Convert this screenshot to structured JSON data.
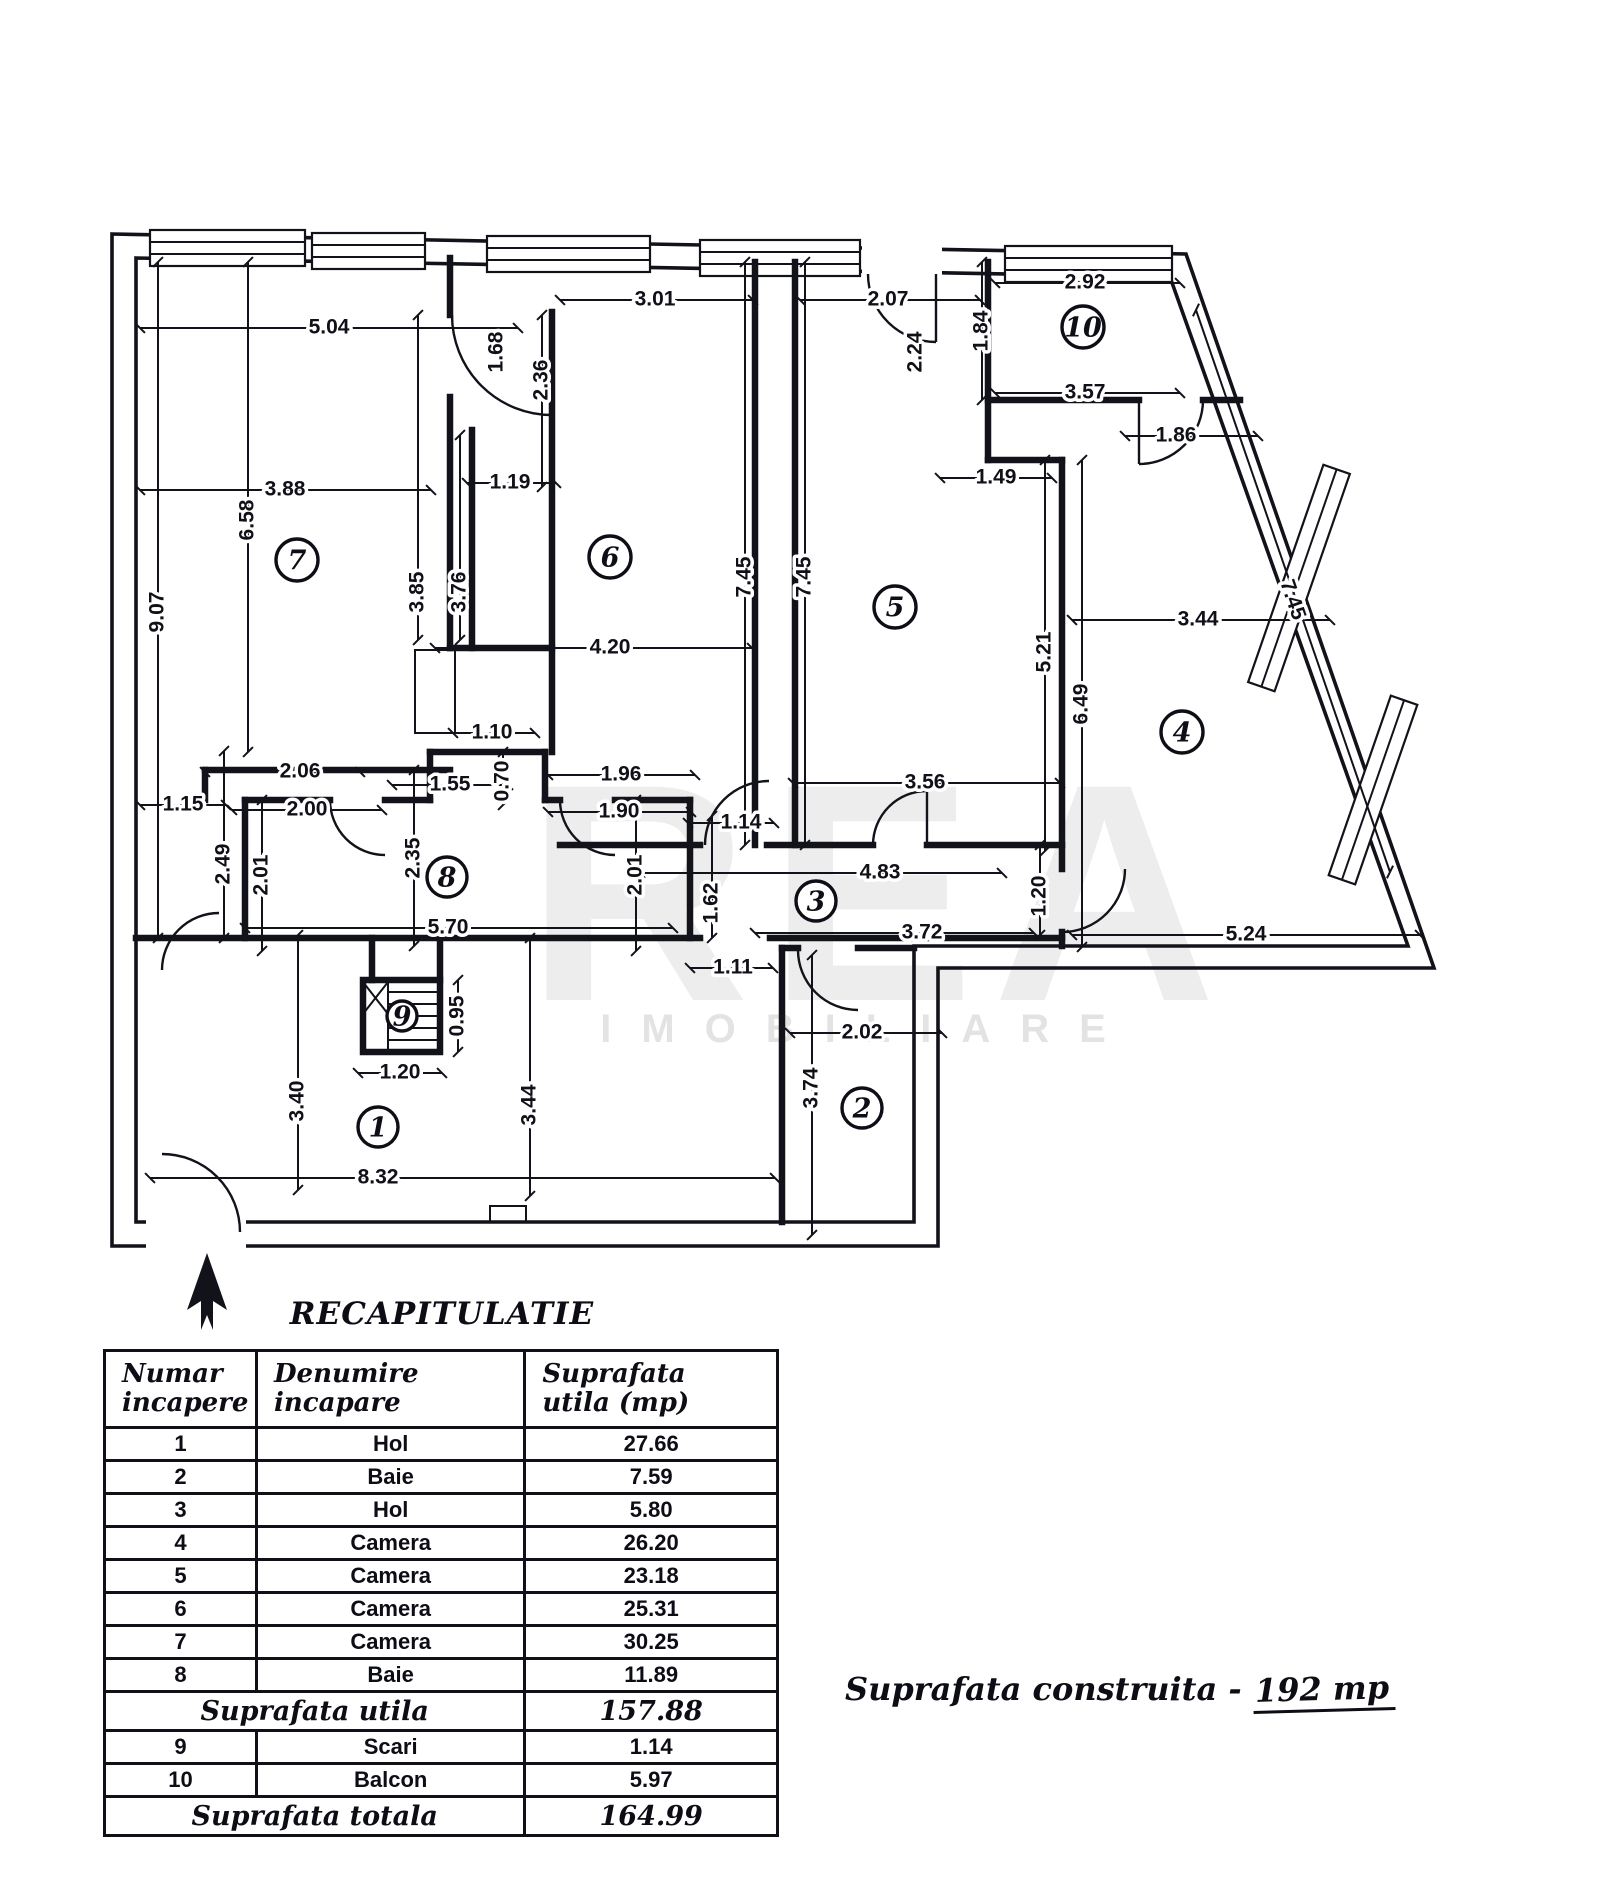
{
  "title": "RECAPITULATIE",
  "watermark": {
    "line1": "REA",
    "line2": "IMOBILIARE"
  },
  "plan": {
    "room_numbers": [
      "1",
      "2",
      "3",
      "4",
      "5",
      "6",
      "7",
      "8",
      "9",
      "10"
    ],
    "dims": [
      "5.04",
      "3.88",
      "6.58",
      "9.07",
      "1.68",
      "2.36",
      "1.19",
      "3.01",
      "3.85",
      "3.76",
      "4.20",
      "1.10",
      "7.45",
      "7.45",
      "2.07",
      "2.24",
      "1.84",
      "2.92",
      "3.57",
      "1.86",
      "1.49",
      "5.21",
      "6.49",
      "3.44",
      "7.45",
      "5.24",
      "3.56",
      "2.06",
      "1.15",
      "2.00",
      "1.55",
      "0.70",
      "1.96",
      "1.90",
      "2.49",
      "2.01",
      "2.35",
      "2.01",
      "1.14",
      "4.83",
      "1.20",
      "5.70",
      "1.62",
      "3.72",
      "1.11",
      "0.95",
      "1.20",
      "3.40",
      "3.44",
      "8.32",
      "2.02",
      "3.74"
    ]
  },
  "table": {
    "headers": [
      [
        "Numar",
        "incapere"
      ],
      [
        "Denumire",
        "incapare"
      ],
      [
        "Suprafata",
        "utila  (mp)"
      ]
    ],
    "rows": [
      {
        "n": "1",
        "name": "Hol",
        "area": "27.66"
      },
      {
        "n": "2",
        "name": "Baie",
        "area": "7.59"
      },
      {
        "n": "3",
        "name": "Hol",
        "area": "5.80"
      },
      {
        "n": "4",
        "name": "Camera",
        "area": "26.20"
      },
      {
        "n": "5",
        "name": "Camera",
        "area": "23.18"
      },
      {
        "n": "6",
        "name": "Camera",
        "area": "25.31"
      },
      {
        "n": "7",
        "name": "Camera",
        "area": "30.25"
      },
      {
        "n": "8",
        "name": "Baie",
        "area": "11.89"
      },
      {
        "type": "summary",
        "name": "Suprafata utila",
        "area": "157.88"
      },
      {
        "n": "9",
        "name": "Scari",
        "area": "1.14"
      },
      {
        "n": "10",
        "name": "Balcon",
        "area": "5.97"
      },
      {
        "type": "summary",
        "name": "Suprafata totala",
        "area": "164.99"
      }
    ]
  },
  "note": {
    "label": "Suprafata construita",
    "dash": "-",
    "value": "192 mp"
  }
}
